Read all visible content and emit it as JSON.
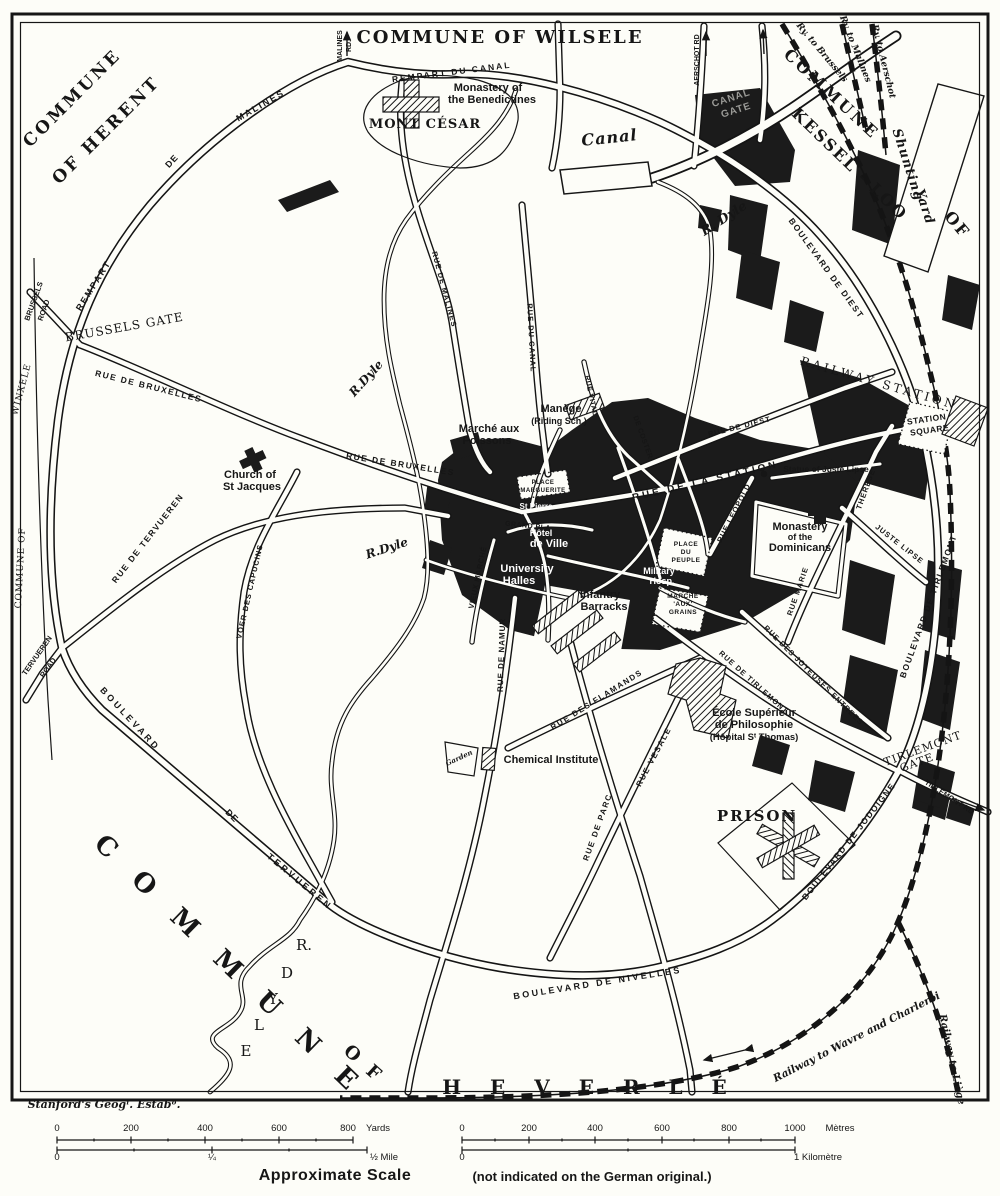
{
  "communes": [
    "COMMUNE OF HERENT",
    "COMMUNE OF WILSELE",
    "COMMUNE OF KESSEL - LOO",
    "COMMUNE OF WINXELE",
    "COMMUNE OF HEVERLÉ"
  ],
  "credit": "Stanford's Geogˡ. Estabᵒ.",
  "scale": {
    "yards_ticks": [
      0,
      200,
      400,
      600,
      800
    ],
    "yards_unit": "Yards",
    "mile_ticks": [
      "0",
      "¼",
      "½ Mile"
    ],
    "metres_ticks": [
      0,
      200,
      400,
      600,
      800,
      1000
    ],
    "metres_unit": "Mètres",
    "kilometre_ticks": [
      "0",
      "1 Kilomètre"
    ],
    "caption": "Approximate Scale",
    "caption_note": "(not indicated on the German original.)"
  },
  "colors": {
    "ink": "#161616",
    "paper": "#fdfdf8"
  },
  "labels": [
    {
      "t": "COMMUNE",
      "x": 76,
      "y": 102,
      "r": -45,
      "s": 17,
      "st": "sc",
      "sp": 3
    },
    {
      "t": "OF HERENT",
      "x": 110,
      "y": 134,
      "r": -45,
      "s": 17,
      "st": "sc",
      "sp": 3
    },
    {
      "t": "COMMUNE OF WILSELE",
      "x": 500,
      "y": 43,
      "r": 0,
      "s": 18,
      "st": "sc",
      "sp": 2
    },
    {
      "t": "COMMUNE",
      "x": 828,
      "y": 98,
      "r": 43,
      "s": 16,
      "st": "sc",
      "sp": 3
    },
    {
      "t": "OF",
      "x": 953,
      "y": 228,
      "r": 50,
      "s": 16,
      "st": "sc",
      "sp": 2
    },
    {
      "t": "KESSEL - LOO",
      "x": 846,
      "y": 168,
      "r": 44,
      "s": 16,
      "st": "sc",
      "sp": 2
    },
    {
      "t": "WINXELE",
      "x": 24,
      "y": 390,
      "r": -75,
      "s": 9,
      "st": "sc2",
      "sp": 1
    },
    {
      "t": "COMMUNE OF",
      "x": 23,
      "y": 568,
      "r": -87,
      "s": 9,
      "st": "sc2",
      "sp": 1
    },
    {
      "t": "C O M M U N E",
      "x": 224,
      "y": 972,
      "r": 44,
      "s": 26,
      "st": "sc",
      "sp": 11
    },
    {
      "t": "O F",
      "x": 360,
      "y": 1068,
      "r": 42,
      "s": 18,
      "st": "sc",
      "sp": 4
    },
    {
      "t": "H E V E R L É",
      "x": 590,
      "y": 1094,
      "r": 0,
      "s": 20,
      "st": "sc",
      "sp": 11
    },
    {
      "t": "BRUSSELS GATE",
      "x": 125,
      "y": 331,
      "r": -10,
      "s": 12,
      "st": "sc2",
      "sp": 1
    },
    {
      "t": "BRUSSELS",
      "x": 36,
      "y": 302,
      "r": -70,
      "s": 7.5,
      "st": "st",
      "sp": 0
    },
    {
      "t": "ROAD",
      "x": 46,
      "y": 311,
      "r": -70,
      "s": 7.5,
      "st": "st",
      "sp": 0
    },
    {
      "t": "TERVUEREN",
      "x": 39,
      "y": 657,
      "r": -55,
      "s": 7.5,
      "st": "st",
      "sp": 0
    },
    {
      "t": "ROAD",
      "x": 50,
      "y": 669,
      "r": -55,
      "s": 7.5,
      "st": "st",
      "sp": 0
    },
    {
      "t": "TIRLEMONT",
      "x": 924,
      "y": 752,
      "r": -20,
      "s": 11,
      "st": "sc2",
      "sp": 1
    },
    {
      "t": "GATE",
      "x": 918,
      "y": 766,
      "r": -20,
      "s": 11,
      "st": "sc2",
      "sp": 1
    },
    {
      "t": "TIRLEMONT RD",
      "x": 948,
      "y": 799,
      "r": 33,
      "s": 7.5,
      "st": "st",
      "sp": 0
    },
    {
      "t": "MALINES",
      "x": 342,
      "y": 46,
      "r": -90,
      "s": 7,
      "st": "st",
      "sp": 0
    },
    {
      "t": "RD.",
      "x": 351,
      "y": 46,
      "r": -90,
      "s": 7,
      "st": "st",
      "sp": 0
    },
    {
      "t": "AERSCHOT RD",
      "x": 699,
      "y": 60,
      "r": -90,
      "s": 7,
      "st": "st",
      "sp": 0
    },
    {
      "t": "CANAL",
      "x": 732,
      "y": 101,
      "r": -18,
      "s": 10,
      "st": "ghost",
      "sp": 1
    },
    {
      "t": "GATE",
      "x": 737,
      "y": 113,
      "r": -18,
      "s": 10,
      "st": "ghost",
      "sp": 1
    },
    {
      "t": "STATION",
      "x": 927,
      "y": 422,
      "r": -8,
      "s": 8.5,
      "st": "st",
      "sp": 0.5
    },
    {
      "t": "SQUARE",
      "x": 930,
      "y": 433,
      "r": -8,
      "s": 8.5,
      "st": "st",
      "sp": 0.5
    },
    {
      "t": "RAILWAY STATION",
      "x": 878,
      "y": 387,
      "r": 16,
      "s": 12,
      "st": "sc2",
      "sp": 3
    },
    {
      "t": "REMPART DU CANAL",
      "x": 452,
      "y": 75,
      "r": -7,
      "s": 8.5,
      "st": "st",
      "sp": 2
    },
    {
      "t": "REMPART",
      "x": 96,
      "y": 287,
      "r": -58,
      "s": 9,
      "st": "st",
      "sp": 2
    },
    {
      "t": "DE",
      "x": 174,
      "y": 163,
      "r": -47,
      "s": 9,
      "st": "st",
      "sp": 1
    },
    {
      "t": "MALINES",
      "x": 262,
      "y": 108,
      "r": -30,
      "s": 9,
      "st": "st",
      "sp": 2
    },
    {
      "t": "RUE DE MALINES",
      "x": 442,
      "y": 290,
      "r": 75,
      "s": 7.5,
      "st": "st",
      "sp": 1
    },
    {
      "t": "RUE DU CANAL",
      "x": 529,
      "y": 338,
      "r": 87,
      "s": 7.5,
      "st": "st",
      "sp": 1
    },
    {
      "t": "RUE DE BRUXELLES",
      "x": 148,
      "y": 389,
      "r": 14,
      "s": 8.5,
      "st": "st",
      "sp": 1.5
    },
    {
      "t": "RUE DE BRUXELLES",
      "x": 400,
      "y": 467,
      "r": 9,
      "s": 8.5,
      "st": "st",
      "sp": 1.5
    },
    {
      "t": "RUE DE TERVUEREN",
      "x": 150,
      "y": 540,
      "r": -52,
      "s": 8.5,
      "st": "st",
      "sp": 1.5
    },
    {
      "t": "VOER DES CAPUCINS",
      "x": 252,
      "y": 592,
      "r": -77,
      "s": 7.5,
      "st": "st",
      "sp": 1
    },
    {
      "t": "BOULEVARD",
      "x": 128,
      "y": 721,
      "r": 47,
      "s": 9,
      "st": "st",
      "sp": 3
    },
    {
      "t": "DE",
      "x": 230,
      "y": 818,
      "r": 45,
      "s": 9,
      "st": "st",
      "sp": 1
    },
    {
      "t": "TERVUEREN",
      "x": 298,
      "y": 884,
      "r": 40,
      "s": 9,
      "st": "st",
      "sp": 3
    },
    {
      "t": "BOULEVARD DE NIVELLES",
      "x": 598,
      "y": 986,
      "r": -9,
      "s": 9,
      "st": "st",
      "sp": 2.5
    },
    {
      "t": "BOULEVARD DE JODOIGNE",
      "x": 851,
      "y": 843,
      "r": -52,
      "s": 8.5,
      "st": "st",
      "sp": 1.5
    },
    {
      "t": "BOULEVARD DE TIRLEMONT",
      "x": 931,
      "y": 607,
      "r": -70,
      "s": 8.5,
      "st": "st",
      "sp": 1.5
    },
    {
      "t": "BOULEVARD DE DIEST",
      "x": 824,
      "y": 270,
      "r": 54,
      "s": 8.5,
      "st": "st",
      "sp": 1.5
    },
    {
      "t": "RUE DE DIEST",
      "x": 740,
      "y": 429,
      "r": -14,
      "s": 7.5,
      "st": "st",
      "sp": 1
    },
    {
      "t": "RUE DE LA STATION",
      "x": 706,
      "y": 484,
      "r": -13,
      "s": 10,
      "st": "st",
      "sp": 3
    },
    {
      "t": "RUE LEOPOLD",
      "x": 736,
      "y": 514,
      "r": -63,
      "s": 7.5,
      "st": "st",
      "sp": 1
    },
    {
      "t": "RUE MARIE",
      "x": 800,
      "y": 592,
      "r": -71,
      "s": 7.5,
      "st": "st",
      "sp": 1
    },
    {
      "t": "THERESE",
      "x": 868,
      "y": 490,
      "r": -70,
      "s": 7.5,
      "st": "st",
      "sp": 1
    },
    {
      "t": "JUSTE LIPSE",
      "x": 898,
      "y": 546,
      "r": 38,
      "s": 7.5,
      "st": "st",
      "sp": 1
    },
    {
      "t": "RUE DES JOYEUSES ENTREES",
      "x": 812,
      "y": 677,
      "r": 45,
      "s": 7.5,
      "st": "st",
      "sp": 1
    },
    {
      "t": "RUE DE TIRLEMONT",
      "x": 752,
      "y": 684,
      "r": 42,
      "s": 7.5,
      "st": "st",
      "sp": 1
    },
    {
      "t": "RUE DES FLAMANDS",
      "x": 598,
      "y": 702,
      "r": -32,
      "s": 8,
      "st": "st",
      "sp": 1.5
    },
    {
      "t": "RUE VESALE",
      "x": 656,
      "y": 758,
      "r": -62,
      "s": 8,
      "st": "st",
      "sp": 1.5
    },
    {
      "t": "RUE DE NAMUR",
      "x": 504,
      "y": 655,
      "r": -88,
      "s": 8,
      "st": "st",
      "sp": 1
    },
    {
      "t": "RUE DE PARC",
      "x": 600,
      "y": 828,
      "r": -70,
      "s": 8,
      "st": "st",
      "sp": 1.5
    },
    {
      "t": "VIEUX MARCHÉ",
      "x": 480,
      "y": 578,
      "r": -78,
      "s": 7.5,
      "st": "st",
      "sp": 0.5
    },
    {
      "t": "GRAND PLA.",
      "x": 529,
      "y": 528,
      "r": 6,
      "s": 7,
      "st": "st",
      "sp": 0.5
    },
    {
      "t": "RUE VITAL",
      "x": 589,
      "y": 396,
      "r": 78,
      "s": 7,
      "st": "st",
      "sp": 0.5
    },
    {
      "t": "DE COSTER",
      "x": 641,
      "y": 438,
      "r": 70,
      "s": 7,
      "st": "st",
      "sp": 0.5
    },
    {
      "t": "Monastery of",
      "x": 488,
      "y": 91,
      "r": 0,
      "s": 11,
      "st": "pl",
      "sp": 0
    },
    {
      "t": "the Benedictines",
      "x": 492,
      "y": 103,
      "r": 0,
      "s": 11,
      "st": "pl",
      "sp": 0
    },
    {
      "t": "MONT CÉSAR",
      "x": 425,
      "y": 128,
      "r": 0,
      "s": 13,
      "st": "sc",
      "sp": 1
    },
    {
      "t": "Canal",
      "x": 610,
      "y": 143,
      "r": -6,
      "s": 16,
      "st": "it",
      "sp": 1
    },
    {
      "t": "R. Dyle",
      "x": 726,
      "y": 222,
      "r": -33,
      "s": 13,
      "st": "it",
      "sp": 0
    },
    {
      "t": "R.Dyle",
      "x": 369,
      "y": 381,
      "r": -48,
      "s": 12,
      "st": "it",
      "sp": 0
    },
    {
      "t": "R.Dyle",
      "x": 388,
      "y": 552,
      "r": -18,
      "s": 12,
      "st": "it",
      "sp": 0
    },
    {
      "t": "Shunting",
      "x": 904,
      "y": 166,
      "r": 72,
      "s": 13,
      "st": "it",
      "sp": 1
    },
    {
      "t": "Yard",
      "x": 921,
      "y": 208,
      "r": 72,
      "s": 13,
      "st": "it",
      "sp": 1
    },
    {
      "t": "Ry. to Brussels",
      "x": 820,
      "y": 54,
      "r": 50,
      "s": 9,
      "st": "it",
      "sp": 0
    },
    {
      "t": "Ry. to Malines",
      "x": 853,
      "y": 50,
      "r": 68,
      "s": 9,
      "st": "it",
      "sp": 0
    },
    {
      "t": "Ry. to Aerschot",
      "x": 881,
      "y": 62,
      "r": 76,
      "s": 9,
      "st": "it",
      "sp": 0
    },
    {
      "t": "Statue of Juste Lipse",
      "x": 826,
      "y": 472,
      "r": 0,
      "s": 8.5,
      "st": "pl",
      "sp": 0
    },
    {
      "t": "Monastery",
      "x": 800,
      "y": 530,
      "r": 0,
      "s": 11,
      "st": "pl",
      "sp": 0
    },
    {
      "t": "of the",
      "x": 800,
      "y": 540,
      "r": 0,
      "s": 9,
      "st": "pl",
      "sp": 0
    },
    {
      "t": "Dominicans",
      "x": 800,
      "y": 551,
      "r": 0,
      "s": 11,
      "st": "pl",
      "sp": 0
    },
    {
      "t": "PLACE",
      "x": 686,
      "y": 546,
      "r": 0,
      "s": 6.5,
      "st": "st",
      "sp": 0.5
    },
    {
      "t": "DU",
      "x": 686,
      "y": 554,
      "r": 0,
      "s": 6.5,
      "st": "st",
      "sp": 0.5
    },
    {
      "t": "PEUPLE",
      "x": 686,
      "y": 562,
      "r": 0,
      "s": 6.5,
      "st": "st",
      "sp": 0.5
    },
    {
      "t": "MARCHÉ",
      "x": 683,
      "y": 598,
      "r": 0,
      "s": 6.5,
      "st": "st",
      "sp": 0.5
    },
    {
      "t": "'AUX'",
      "x": 683,
      "y": 606,
      "r": 0,
      "s": 6.5,
      "st": "st",
      "sp": 0.5
    },
    {
      "t": "GRAINS",
      "x": 683,
      "y": 614,
      "r": 0,
      "s": 6.5,
      "st": "st",
      "sp": 0.5
    },
    {
      "t": "Military",
      "x": 659,
      "y": 574,
      "r": 0,
      "s": 9,
      "st": "wh",
      "sp": 0
    },
    {
      "t": "Hosp.",
      "x": 662,
      "y": 584,
      "r": 0,
      "s": 9,
      "st": "wh",
      "sp": 0
    },
    {
      "t": "Infantry",
      "x": 600,
      "y": 598,
      "r": 0,
      "s": 11,
      "st": "pl",
      "sp": 0
    },
    {
      "t": "Barracks",
      "x": 604,
      "y": 610,
      "r": 0,
      "s": 11,
      "st": "pl",
      "sp": 0
    },
    {
      "t": "Marché aux",
      "x": 489,
      "y": 432,
      "r": 0,
      "s": 11,
      "st": "pl",
      "sp": 0
    },
    {
      "t": "Poissons",
      "x": 487,
      "y": 444,
      "r": 0,
      "s": 11,
      "st": "pl",
      "sp": 0
    },
    {
      "t": "Manège",
      "x": 561,
      "y": 412,
      "r": 0,
      "s": 11,
      "st": "pl",
      "sp": 0
    },
    {
      "t": "(Riding Sch.)",
      "x": 559,
      "y": 424,
      "r": 0,
      "s": 9,
      "st": "pl",
      "sp": 0
    },
    {
      "t": "PLACE",
      "x": 543,
      "y": 484,
      "r": 0,
      "s": 6,
      "st": "st",
      "sp": 0.5
    },
    {
      "t": "MARGUERITE",
      "x": 543,
      "y": 492,
      "r": 0,
      "s": 6,
      "st": "st",
      "sp": 0.5
    },
    {
      "t": "St Pierre",
      "x": 536,
      "y": 509,
      "r": 0,
      "s": 8,
      "st": "wh",
      "sp": 0
    },
    {
      "t": "Hôtel",
      "x": 541,
      "y": 536,
      "r": 0,
      "s": 9,
      "st": "wh",
      "sp": 0
    },
    {
      "t": "de Ville",
      "x": 549,
      "y": 547,
      "r": 0,
      "s": 11,
      "st": "wh",
      "sp": 0
    },
    {
      "t": "University",
      "x": 527,
      "y": 572,
      "r": 0,
      "s": 11,
      "st": "wh",
      "sp": 0
    },
    {
      "t": "Halles",
      "x": 519,
      "y": 584,
      "r": 0,
      "s": 11,
      "st": "wh",
      "sp": 0
    },
    {
      "t": "Church of",
      "x": 250,
      "y": 478,
      "r": 0,
      "s": 11,
      "st": "pl",
      "sp": 0
    },
    {
      "t": "St Jacques",
      "x": 252,
      "y": 490,
      "r": 0,
      "s": 11,
      "st": "pl",
      "sp": 0
    },
    {
      "t": "École Supérieur",
      "x": 754,
      "y": 716,
      "r": 0,
      "s": 11,
      "st": "pl",
      "sp": 0
    },
    {
      "t": "de Philosophie",
      "x": 754,
      "y": 728,
      "r": 0,
      "s": 11,
      "st": "pl",
      "sp": 0
    },
    {
      "t": "(Hôpital Sᵗ Thomas)",
      "x": 754,
      "y": 740,
      "r": 0,
      "s": 9.5,
      "st": "pl",
      "sp": 0
    },
    {
      "t": "Chemical Institute",
      "x": 551,
      "y": 763,
      "r": 0,
      "s": 11,
      "st": "pl",
      "sp": 0
    },
    {
      "t": "Garden",
      "x": 460,
      "y": 760,
      "r": -25,
      "s": 7,
      "st": "it",
      "sp": 0
    },
    {
      "t": "PRISON",
      "x": 757,
      "y": 821,
      "r": 0,
      "s": 15,
      "st": "sc",
      "sp": 2
    },
    {
      "t": "Railway to Wavre and Charleroi",
      "x": 858,
      "y": 1040,
      "r": -27,
      "s": 10.5,
      "st": "it",
      "sp": 0
    },
    {
      "t": "Railway to Liège",
      "x": 949,
      "y": 1060,
      "r": 78,
      "s": 10,
      "st": "it",
      "sp": 0
    },
    {
      "t": "Stanford's Geogˡ. Estabᵒ.",
      "x": 104,
      "y": 1108,
      "r": 0,
      "s": 11,
      "st": "it",
      "sp": 0
    },
    {
      "t": "R.",
      "x": 304,
      "y": 950,
      "r": 0,
      "s": 15,
      "st": "sc2",
      "sp": 0
    },
    {
      "t": "D",
      "x": 287,
      "y": 978,
      "r": 0,
      "s": 15,
      "st": "sc2",
      "sp": 0
    },
    {
      "t": "Y",
      "x": 273,
      "y": 1004,
      "r": 0,
      "s": 15,
      "st": "sc2",
      "sp": 0
    },
    {
      "t": "L",
      "x": 259,
      "y": 1030,
      "r": 0,
      "s": 15,
      "st": "sc2",
      "sp": 0
    },
    {
      "t": "E",
      "x": 246,
      "y": 1056,
      "r": 0,
      "s": 15,
      "st": "sc2",
      "sp": 0
    },
    {
      "t": "0",
      "x": 57,
      "y": 1131,
      "r": 0,
      "s": 9.5,
      "st": "scl",
      "sp": 0
    },
    {
      "t": "200",
      "x": 131,
      "y": 1131,
      "r": 0,
      "s": 9.5,
      "st": "scl",
      "sp": 0
    },
    {
      "t": "400",
      "x": 205,
      "y": 1131,
      "r": 0,
      "s": 9.5,
      "st": "scl",
      "sp": 0
    },
    {
      "t": "600",
      "x": 279,
      "y": 1131,
      "r": 0,
      "s": 9.5,
      "st": "scl",
      "sp": 0
    },
    {
      "t": "800",
      "x": 348,
      "y": 1131,
      "r": 0,
      "s": 9.5,
      "st": "scl",
      "sp": 0
    },
    {
      "t": "Yards",
      "x": 378,
      "y": 1131,
      "r": 0,
      "s": 9.5,
      "st": "scl",
      "sp": 0
    },
    {
      "t": "0",
      "x": 57,
      "y": 1160,
      "r": 0,
      "s": 9.5,
      "st": "scl",
      "sp": 0
    },
    {
      "t": "¼",
      "x": 212,
      "y": 1160,
      "r": 0,
      "s": 9.5,
      "st": "scl",
      "sp": 0
    },
    {
      "t": "½ Mile",
      "x": 384,
      "y": 1160,
      "r": 0,
      "s": 9.5,
      "st": "scl",
      "sp": 0
    },
    {
      "t": "0",
      "x": 462,
      "y": 1131,
      "r": 0,
      "s": 9.5,
      "st": "scl",
      "sp": 0
    },
    {
      "t": "200",
      "x": 529,
      "y": 1131,
      "r": 0,
      "s": 9.5,
      "st": "scl",
      "sp": 0
    },
    {
      "t": "400",
      "x": 595,
      "y": 1131,
      "r": 0,
      "s": 9.5,
      "st": "scl",
      "sp": 0
    },
    {
      "t": "600",
      "x": 662,
      "y": 1131,
      "r": 0,
      "s": 9.5,
      "st": "scl",
      "sp": 0
    },
    {
      "t": "800",
      "x": 729,
      "y": 1131,
      "r": 0,
      "s": 9.5,
      "st": "scl",
      "sp": 0
    },
    {
      "t": "1000",
      "x": 795,
      "y": 1131,
      "r": 0,
      "s": 9.5,
      "st": "scl",
      "sp": 0
    },
    {
      "t": "Mètres",
      "x": 840,
      "y": 1131,
      "r": 0,
      "s": 9.5,
      "st": "scl",
      "sp": 0
    },
    {
      "t": "0",
      "x": 462,
      "y": 1160,
      "r": 0,
      "s": 9.5,
      "st": "scl",
      "sp": 0
    },
    {
      "t": "1 Kilomètre",
      "x": 818,
      "y": 1160,
      "r": 0,
      "s": 9.5,
      "st": "scl",
      "sp": 0
    },
    {
      "t": "Approximate Scale",
      "x": 335,
      "y": 1180,
      "r": 0,
      "s": 16,
      "st": "pl",
      "sp": 0.5
    },
    {
      "t": "(not indicated on the German original.)",
      "x": 592,
      "y": 1181,
      "r": 0,
      "s": 13,
      "st": "pl",
      "sp": 0
    }
  ]
}
